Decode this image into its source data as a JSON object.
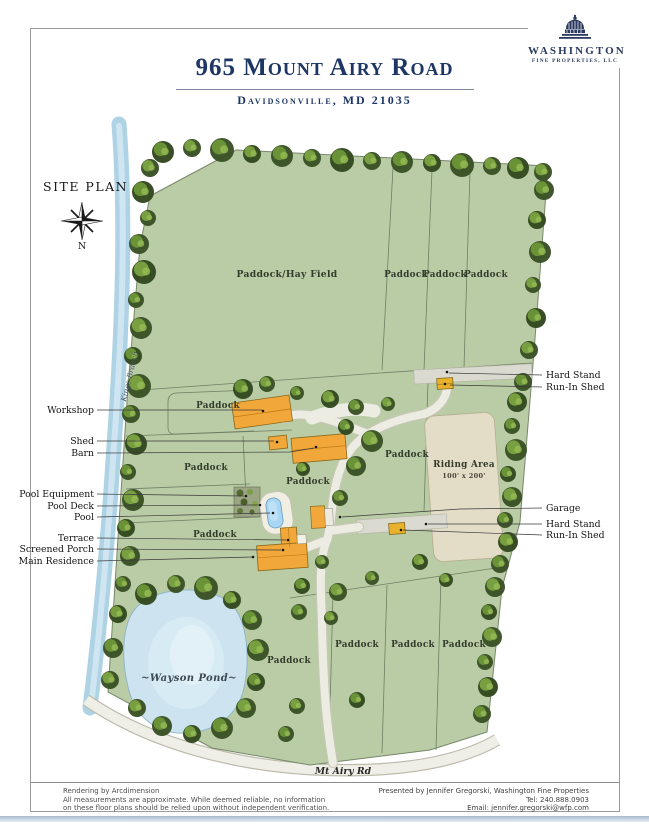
{
  "header": {
    "title": "965 Mount Airy Road",
    "subtitle": "Davidsonville, MD 21035",
    "logo": {
      "name": "WASHINGTON",
      "tagline": "FINE PROPERTIES, LLC"
    }
  },
  "site_plan_label": "SITE PLAN",
  "compass": {
    "north": "N"
  },
  "map": {
    "areas": {
      "hay_field": "Paddock/Hay Field",
      "paddock": "Paddock",
      "riding_area_title": "Riding Area",
      "riding_area_size": "100' x 200'",
      "pond": "~Wayson Pond~",
      "stream": "Kings Branch",
      "road": "Mt Airy Rd"
    },
    "left_labels": [
      "Workshop",
      "Shed",
      "Barn",
      "Pool Equipment",
      "Pool Deck",
      "Pool",
      "Terrace",
      "Screened Porch",
      "Main Residence"
    ],
    "right_labels": [
      "Hard Stand",
      "Run-In Shed",
      "Garage",
      "Hard Stand",
      "Run-In Shed"
    ]
  },
  "footer": {
    "left_lines": [
      "Rendering by Arcdimension",
      "All measurements are approximate. While deemed reliable, no information",
      "on these floor plans should be relied upon without independent verification."
    ],
    "right_lines": [
      "Presented by Jennifer Gregorski, Washington Fine Properties",
      "Tel: 240.888.0903",
      "Email: jennifer.gregorski@wfp.com"
    ]
  },
  "colors": {
    "accent_navy": "#1d3665",
    "field_green": "#b9cca6",
    "tree_dark": "#3a5126",
    "tree_light": "#6f9a3a",
    "water_blue": "#cde4f0",
    "building_orange": "#f1a73a",
    "riding_beige": "#e3ddc7"
  }
}
